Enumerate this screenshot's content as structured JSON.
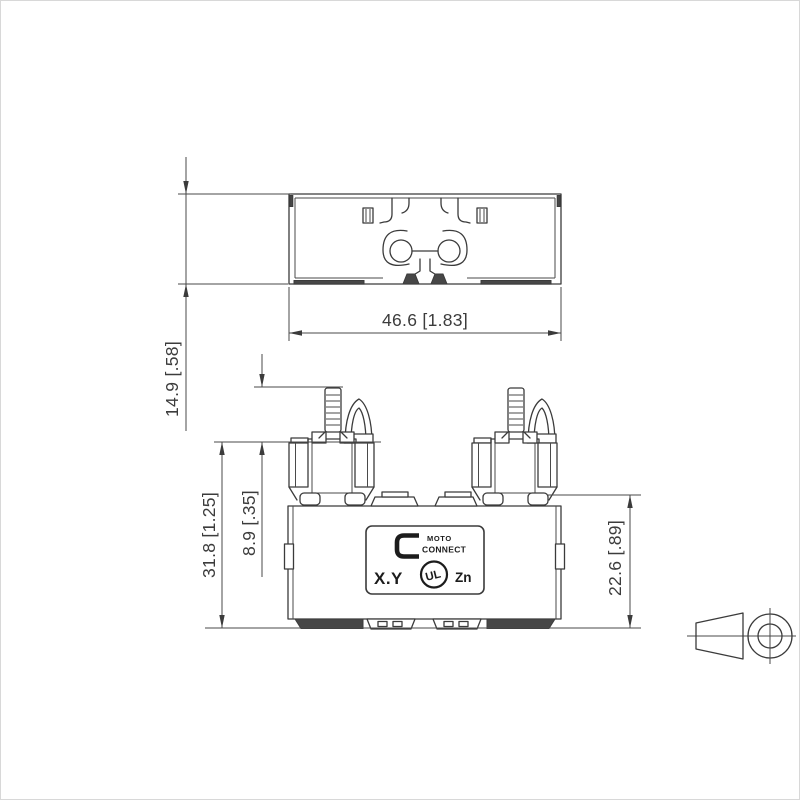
{
  "drawing": {
    "kind": "technical-dimension-drawing",
    "dimensions": {
      "top_view_width": "46.6 [1.83]",
      "top_view_height": "14.9 [.58]",
      "overall_height": "31.8 [1.25]",
      "terminal_stud_height": "8.9 [.35]",
      "body_height": "22.6 [.89]"
    },
    "label": {
      "logo_top": "MOTO",
      "logo_bottom": "CONNECT",
      "rating": "X.Y",
      "cert": "UL",
      "material": "Zn"
    },
    "icons": {
      "projection_symbol": "first-angle-projection"
    },
    "colors": {
      "line": "#3b3b3b",
      "background": "#ffffff"
    }
  }
}
